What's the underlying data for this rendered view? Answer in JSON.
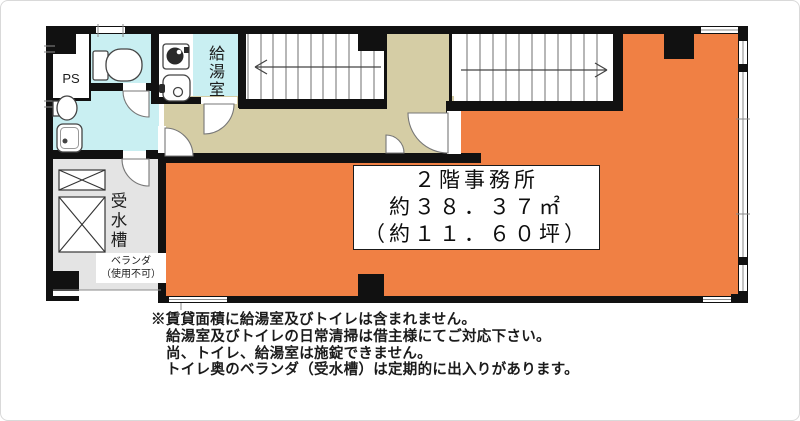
{
  "floor_plan": {
    "rooms": {
      "ps_label": "PS",
      "kitchen_label": "給湯室",
      "water_tank_label": "受水槽",
      "veranda_label_line1": "ベランダ",
      "veranda_label_line2": "（使用不可）"
    },
    "info_box": {
      "title": "２階事務所",
      "area_sqm": "約３８．３７㎡",
      "area_tsubo": "（約１１．６０坪）"
    },
    "colors": {
      "office": "#F08044",
      "wet_area": "#C9EFF2",
      "corridor": "#D5CDA5",
      "balcony": "#E4E4E4",
      "wall": "#111111"
    }
  },
  "notes": {
    "line1": "※賃貸面積に給湯室及びトイレは含まれません。",
    "line2": "給湯室及びトイレの日常清掃は借主様にてご対応下さい。",
    "line3": "尚、トイレ、給湯室は施錠できません。",
    "line4": "トイレ奥のベランダ（受水槽）は定期的に出入りがあります。"
  }
}
